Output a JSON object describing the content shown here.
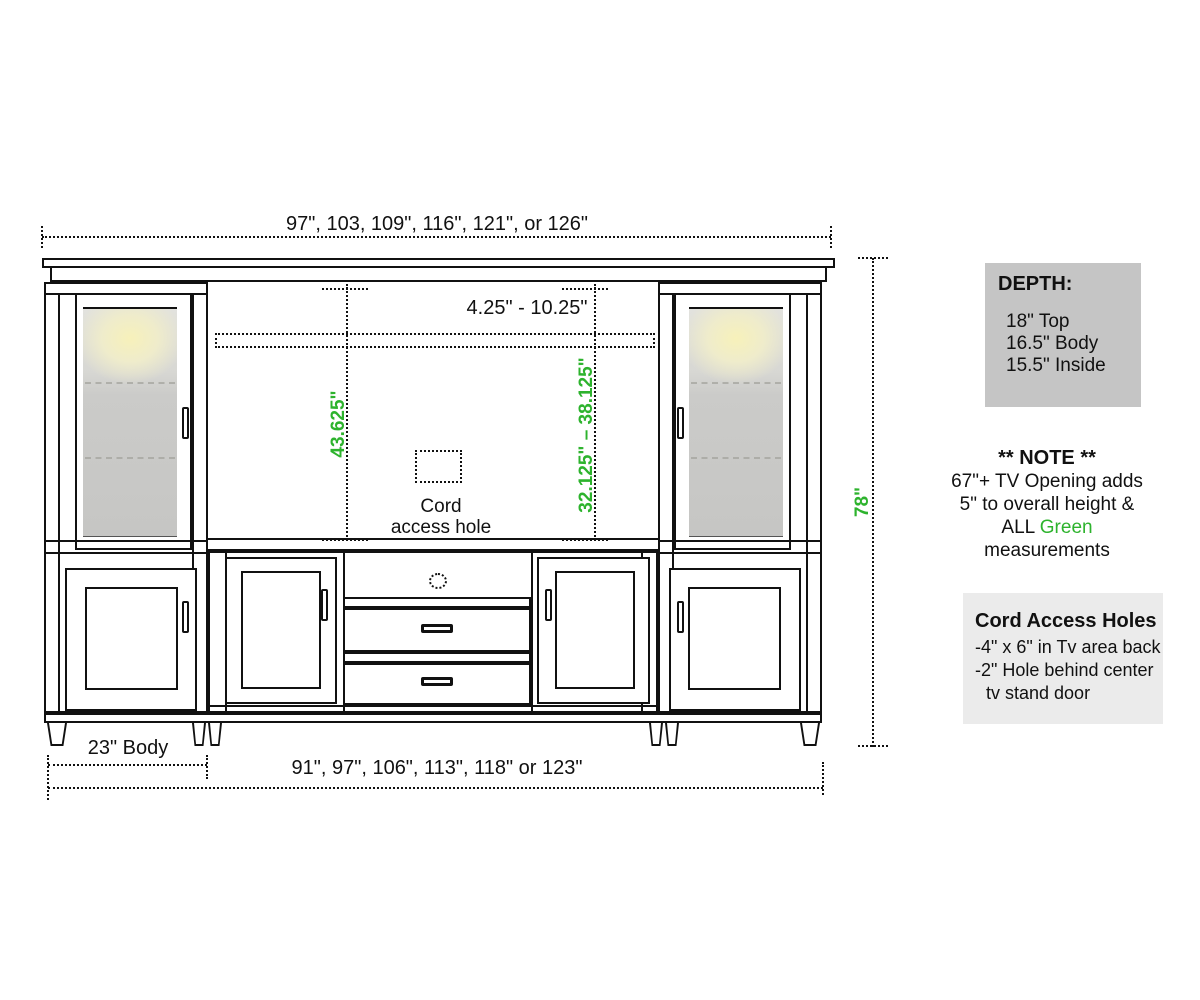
{
  "colors": {
    "green": "#2db32d",
    "line": "#111111",
    "depth_bg": "#c5c5c5",
    "cord_bg": "#ebebeb"
  },
  "dimensions": {
    "top_width": "97\", 103, 109\", 116\", 121\", or 126\"",
    "tv_opening_gap": "4.25\" - 10.25\"",
    "tv_opening_height": "43.625\"",
    "tv_height_range": "32.125\" – 38.125\"",
    "overall_height": "78\"",
    "body_depth_width": "23\" Body",
    "bottom_width": "91\", 97\", 106\", 113\", 118\" or 123\""
  },
  "labels": {
    "cord_hole_line1": "Cord",
    "cord_hole_line2": "access hole"
  },
  "depth_box": {
    "title": "DEPTH:",
    "lines": [
      "18\" Top",
      "16.5\" Body",
      "15.5\" Inside"
    ]
  },
  "note": {
    "title": "** NOTE **",
    "line1": "67\"+ TV Opening adds",
    "line2": "5\" to overall height &",
    "line3_prefix": "ALL ",
    "line3_green": "Green",
    "line4": "measurements"
  },
  "cord_access_box": {
    "title": "Cord Access Holes",
    "line1": "-4\" x 6\" in Tv area back",
    "line2": "-2\" Hole behind center",
    "line3": "tv stand door"
  }
}
